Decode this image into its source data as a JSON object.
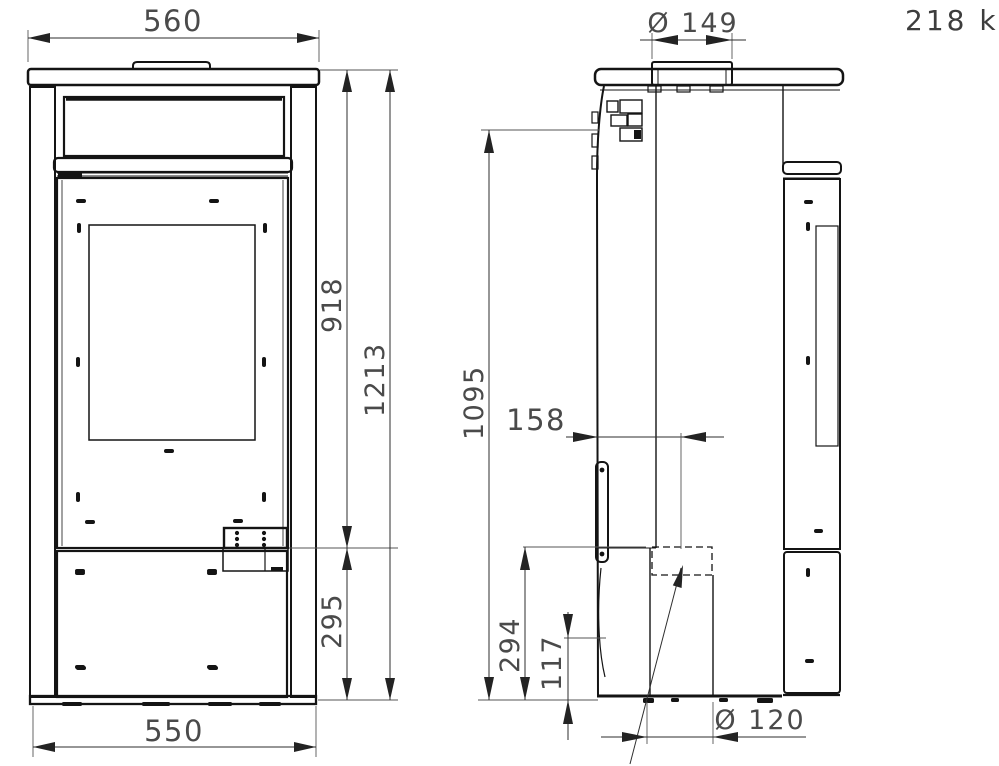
{
  "drawing": {
    "weight": "218 kg",
    "front_view": {
      "top_width": "560",
      "bottom_width": "550",
      "total_height": "1213",
      "upper_height": "918",
      "base_height": "295"
    },
    "side_view": {
      "flue_diameter": "Ø 149",
      "control_height": "1095",
      "outlet_offset": "158",
      "outlet_height": "294",
      "bottom_edge_height": "117",
      "rear_outlet_diameter": "Ø 120"
    },
    "colors": {
      "line": "#141414",
      "dimension_text": "#4a4a4a",
      "background": "#ffffff"
    }
  }
}
